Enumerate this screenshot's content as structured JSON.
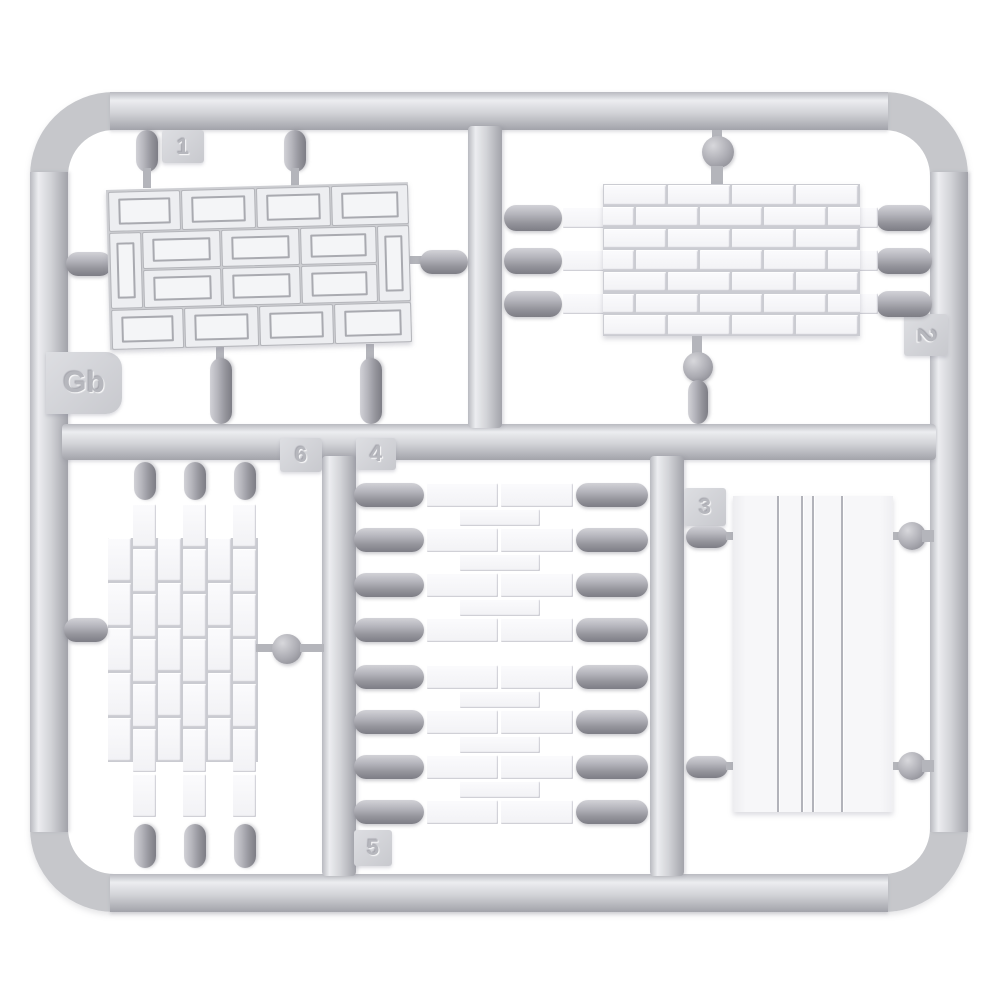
{
  "sprue": {
    "mold_label": "Gb",
    "labels": {
      "gb": "Gb",
      "p1": "1",
      "p2": "2",
      "p3": "3",
      "p4": "4",
      "p5": "5",
      "p6": "6"
    },
    "parts": [
      {
        "number": "1",
        "name": "framed-brick-panel"
      },
      {
        "number": "2",
        "name": "brick-wall-section"
      },
      {
        "number": "3",
        "name": "grooved-flat-panel"
      },
      {
        "number": "4",
        "name": "brick-strip-upper"
      },
      {
        "number": "5",
        "name": "brick-strip-lower"
      },
      {
        "number": "6",
        "name": "vertical-brick-wall"
      }
    ],
    "colors": {
      "runner": "#c6c7cb",
      "gate": "#94949b",
      "part": "#f6f6f8",
      "background": "#ffffff"
    }
  }
}
